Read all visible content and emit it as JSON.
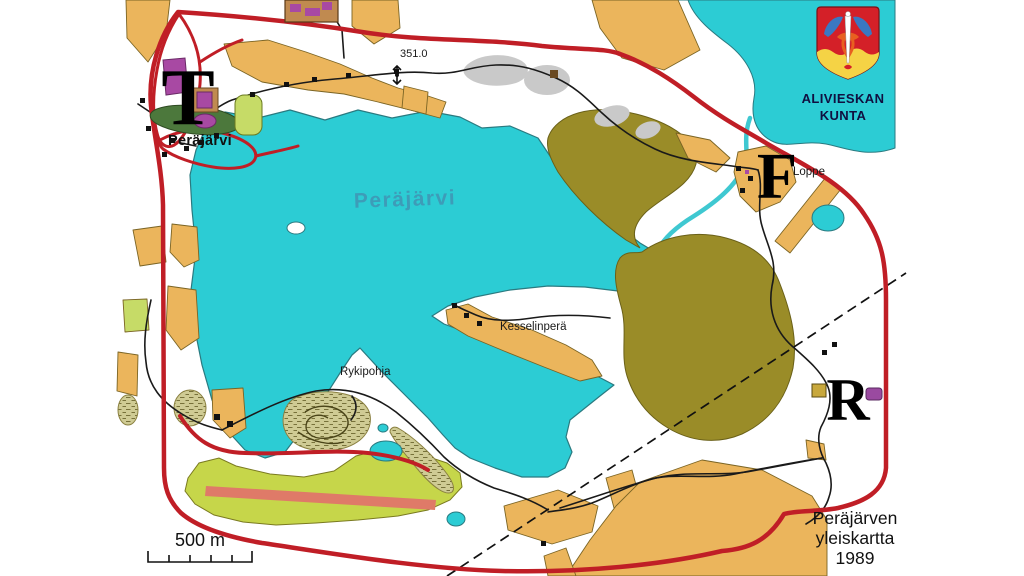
{
  "map": {
    "lake_label": "Peräjärvi",
    "village_label": "Peräjärvi",
    "spot_height": "351.0",
    "place_kesselinpera": "Kesselinperä",
    "place_rykipohja": "Rykipohja",
    "place_loppe": "Loppe",
    "marker_t": "T",
    "marker_f": "F",
    "marker_r": "R"
  },
  "municipality": {
    "name_line1": "ALIVIESKAN",
    "name_line2": "KUNTA"
  },
  "title_block": {
    "line1": "Peräjärven",
    "line2": "yleiskartta",
    "line3": "1989"
  },
  "scale_bar": {
    "label": "500 m"
  },
  "colors": {
    "water": "#2cccd4",
    "field_tan": "#ebb55c",
    "forest_olive": "#9a8c28",
    "open_green": "#c6d64a",
    "track_stripe": "#df7a68",
    "road_red": "#c01e26",
    "building_purple": "#a849a3",
    "rock_gray": "#c9c9c9",
    "marsh": "#cfcb94",
    "shield_red": "#d42028",
    "shield_yellow": "#f5d345",
    "shield_blue": "#3a78c2"
  }
}
